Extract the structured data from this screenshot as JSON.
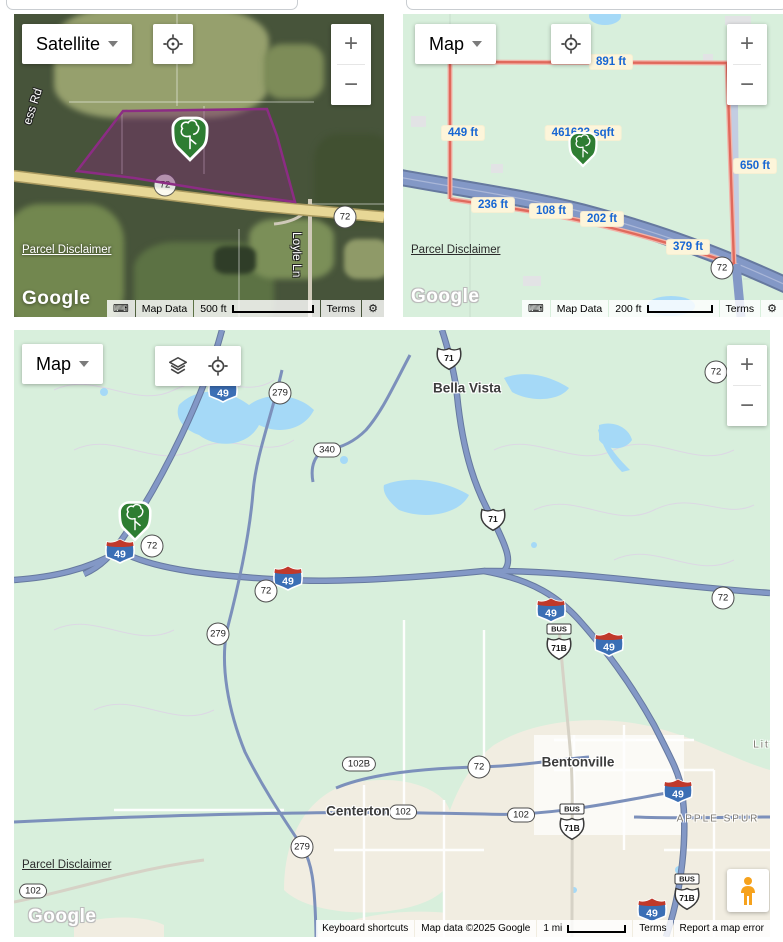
{
  "colors": {
    "map_green": "#d8efdc",
    "water_blue": "#a5d9f7",
    "urban_cream": "#f1ede1",
    "highway_fill": "#8398c6",
    "highway_casing": "#66799f",
    "parcel_line_red": "#e0695c",
    "parcel_fill_purple": "rgba(122,44,112,0.45)",
    "parcel_border_purple": "#8c2c84",
    "marker_green": "#2e7d32",
    "measure_text_blue": "#1766d3",
    "measure_bg_cream": "#fdf5da",
    "satellite_road_yellow": "#e7d796"
  },
  "satellite_map": {
    "map_type_label": "Satellite",
    "zoom_in": "+",
    "zoom_out": "−",
    "route_shields": [
      "72",
      "72"
    ],
    "street_labels": {
      "left": "ess Rd",
      "right": "Loyle Ln"
    },
    "parcel_disclaimer": "Parcel Disclaimer",
    "logo": "Google",
    "attribution": {
      "map_data": "Map Data",
      "scale": "500 ft",
      "terms": "Terms"
    }
  },
  "parcel_map": {
    "map_type_label": "Map",
    "zoom_in": "+",
    "zoom_out": "−",
    "area_label": "461623 sqft",
    "measurements": [
      {
        "text": "891 ft",
        "x": 208,
        "y": 48
      },
      {
        "text": "449 ft",
        "x": 60,
        "y": 119
      },
      {
        "text": "650 ft",
        "x": 352,
        "y": 152
      },
      {
        "text": "236 ft",
        "x": 90,
        "y": 191
      },
      {
        "text": "108 ft",
        "x": 148,
        "y": 197
      },
      {
        "text": "202 ft",
        "x": 199,
        "y": 205
      },
      {
        "text": "379 ft",
        "x": 285,
        "y": 233
      }
    ],
    "route_shield": "72",
    "parcel_disclaimer": "Parcel Disclaimer",
    "logo": "Google",
    "attribution": {
      "map_data": "Map Data",
      "scale": "200 ft",
      "terms": "Terms"
    }
  },
  "overview_map": {
    "map_type_label": "Map",
    "zoom_in": "+",
    "zoom_out": "−",
    "cities": [
      {
        "text": "Bella Vista",
        "x": 453,
        "y": 58
      },
      {
        "text": "Bentonville",
        "x": 564,
        "y": 432
      },
      {
        "text": "Centerton",
        "x": 344,
        "y": 481
      }
    ],
    "places": [
      {
        "text": "APPLE SPUR",
        "x": 704,
        "y": 489
      },
      {
        "text": "Littl",
        "x": 752,
        "y": 415
      }
    ],
    "shields": [
      {
        "cls": "us",
        "label": "71",
        "x": 435,
        "y": 28
      },
      {
        "cls": "interstate",
        "label": "49",
        "x": 209,
        "y": 60
      },
      {
        "cls": "circle",
        "label": "279",
        "x": 266,
        "y": 63
      },
      {
        "cls": "circle",
        "label": "72",
        "x": 702,
        "y": 42
      },
      {
        "cls": "pill",
        "label": "340",
        "x": 313,
        "y": 120
      },
      {
        "cls": "us",
        "label": "71",
        "x": 479,
        "y": 189
      },
      {
        "cls": "interstate",
        "label": "49",
        "x": 106,
        "y": 221
      },
      {
        "cls": "circle",
        "label": "72",
        "x": 138,
        "y": 216
      },
      {
        "cls": "interstate",
        "label": "49",
        "x": 274,
        "y": 248
      },
      {
        "cls": "circle",
        "label": "72",
        "x": 252,
        "y": 261
      },
      {
        "cls": "circle",
        "label": "279",
        "x": 204,
        "y": 304
      },
      {
        "cls": "circle",
        "label": "72",
        "x": 709,
        "y": 268
      },
      {
        "cls": "interstate",
        "label": "49",
        "x": 537,
        "y": 280
      },
      {
        "cls": "busus",
        "banner": "BUS",
        "label": "71B",
        "x": 545,
        "y": 312
      },
      {
        "cls": "interstate",
        "label": "49",
        "x": 595,
        "y": 314
      },
      {
        "cls": "pill",
        "label": "102B",
        "x": 345,
        "y": 434
      },
      {
        "cls": "circle",
        "label": "72",
        "x": 465,
        "y": 437
      },
      {
        "cls": "pill",
        "label": "102",
        "x": 389,
        "y": 482
      },
      {
        "cls": "pill",
        "label": "102",
        "x": 507,
        "y": 485
      },
      {
        "cls": "busus",
        "banner": "BUS",
        "label": "71B",
        "x": 558,
        "y": 492
      },
      {
        "cls": "interstate",
        "label": "49",
        "x": 664,
        "y": 461
      },
      {
        "cls": "circle",
        "label": "279",
        "x": 288,
        "y": 517
      },
      {
        "cls": "pill",
        "label": "102",
        "x": 19,
        "y": 561
      },
      {
        "cls": "interstate",
        "label": "49",
        "x": 638,
        "y": 580
      },
      {
        "cls": "busus",
        "banner": "BUS",
        "label": "71B",
        "x": 673,
        "y": 562
      }
    ],
    "parcel_disclaimer": "Parcel Disclaimer",
    "logo": "Google",
    "attribution": {
      "keyboard_shortcuts": "Keyboard shortcuts",
      "map_data": "Map data ©2025 Google",
      "scale": "1 mi",
      "terms": "Terms",
      "report_error": "Report a map error"
    }
  }
}
